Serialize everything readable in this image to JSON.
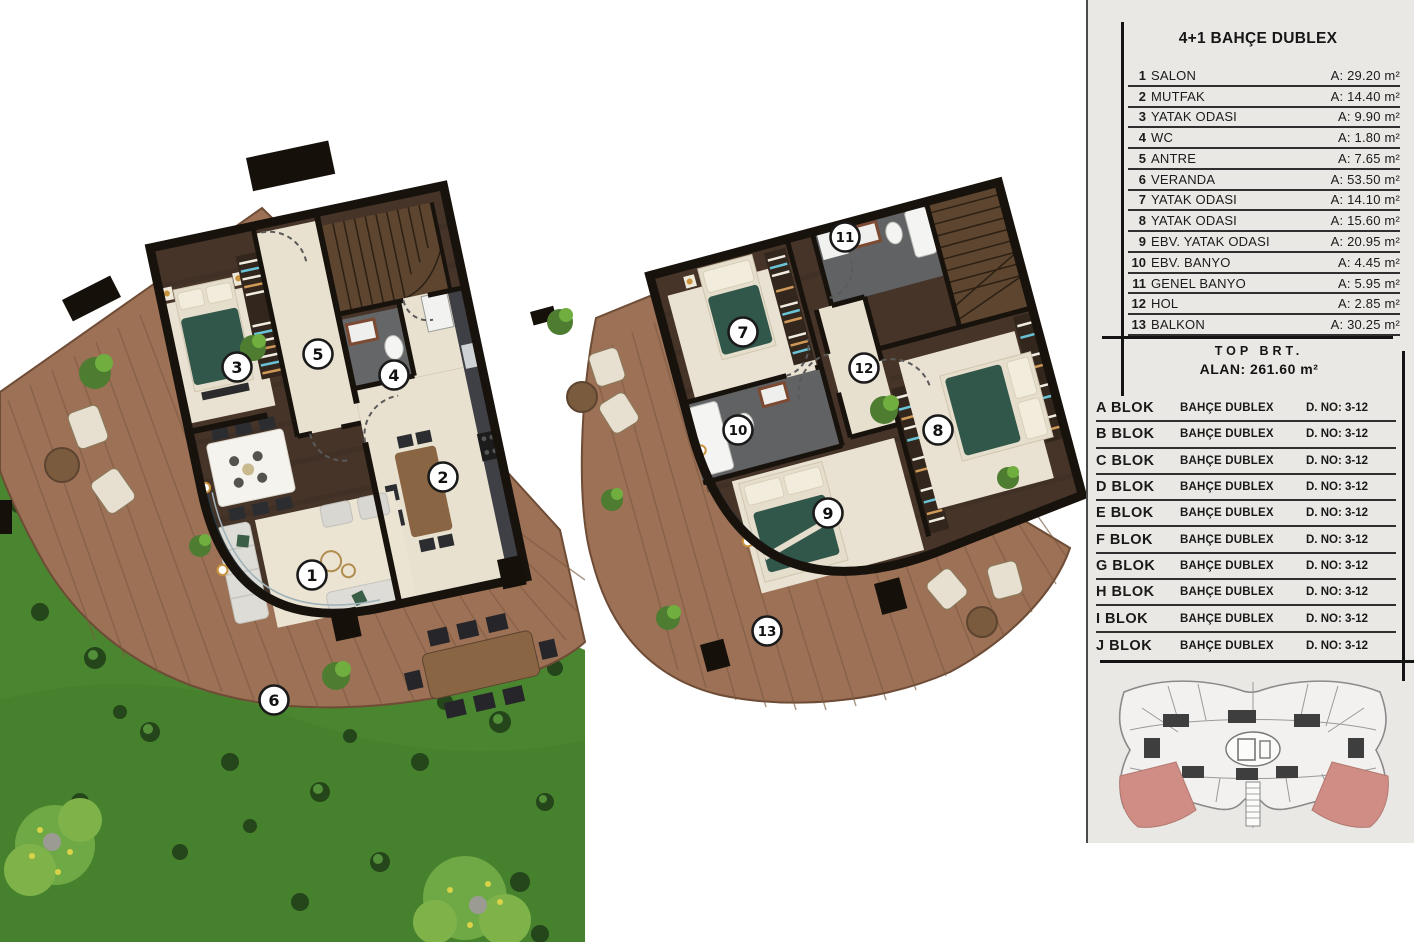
{
  "panel": {
    "title": "4+1 BAHÇE DUBLEX",
    "rooms": [
      {
        "no": "1",
        "name": "SALON",
        "area": "A: 29.20 m²"
      },
      {
        "no": "2",
        "name": "MUTFAK",
        "area": "A: 14.40 m²"
      },
      {
        "no": "3",
        "name": "YATAK ODASI",
        "area": "A:  9.90  m²"
      },
      {
        "no": "4",
        "name": "WC",
        "area": "A:  1.80  m²"
      },
      {
        "no": "5",
        "name": "ANTRE",
        "area": "A:  7.65  m²"
      },
      {
        "no": "6",
        "name": "VERANDA",
        "area": "A: 53.50 m²"
      },
      {
        "no": "7",
        "name": "YATAK ODASI",
        "area": "A: 14.10 m²"
      },
      {
        "no": "8",
        "name": "YATAK ODASI",
        "area": "A: 15.60 m²"
      },
      {
        "no": "9",
        "name": "EBV. YATAK ODASI",
        "area": "A: 20.95 m²"
      },
      {
        "no": "10",
        "name": "EBV. BANYO",
        "area": "A:  4.45  m²"
      },
      {
        "no": "11",
        "name": "GENEL BANYO",
        "area": "A:  5.95  m²"
      },
      {
        "no": "12",
        "name": "HOL",
        "area": "A:  2.85  m²"
      },
      {
        "no": "13",
        "name": "BALKON",
        "area": "A: 30.25 m²"
      }
    ],
    "total_label": "TOP BRT.",
    "total_area": "ALAN: 261.60 m²",
    "blocks": [
      {
        "name": "A BLOK",
        "type": "BAHÇE DUBLEX",
        "door": "D. NO: 3-12"
      },
      {
        "name": "B BLOK",
        "type": "BAHÇE DUBLEX",
        "door": "D. NO: 3-12"
      },
      {
        "name": "C BLOK",
        "type": "BAHÇE DUBLEX",
        "door": "D. NO: 3-12"
      },
      {
        "name": "D BLOK",
        "type": "BAHÇE DUBLEX",
        "door": "D. NO: 3-12"
      },
      {
        "name": "E  BLOK",
        "type": "BAHÇE DUBLEX",
        "door": "D. NO: 3-12"
      },
      {
        "name": "F  BLOK",
        "type": "BAHÇE DUBLEX",
        "door": "D. NO: 3-12"
      },
      {
        "name": "G BLOK",
        "type": "BAHÇE DUBLEX",
        "door": "D. NO: 3-12"
      },
      {
        "name": "H BLOK",
        "type": "BAHÇE DUBLEX",
        "door": "D. NO: 3-12"
      },
      {
        "name": "I  BLOK",
        "type": "BAHÇE DUBLEX",
        "door": "D. NO: 3-12"
      },
      {
        "name": "J  BLOK",
        "type": "BAHÇE DUBLEX",
        "door": "D. NO: 3-12"
      }
    ],
    "key_plan": {
      "highlight_color": "#cf8d86",
      "line_color": "#8a8a8a"
    }
  },
  "plans": {
    "garden_floor": {
      "markers": [
        "1",
        "2",
        "3",
        "4",
        "5",
        "6"
      ]
    },
    "upper_floor": {
      "markers": [
        "7",
        "8",
        "9",
        "10",
        "11",
        "12",
        "13"
      ]
    }
  }
}
